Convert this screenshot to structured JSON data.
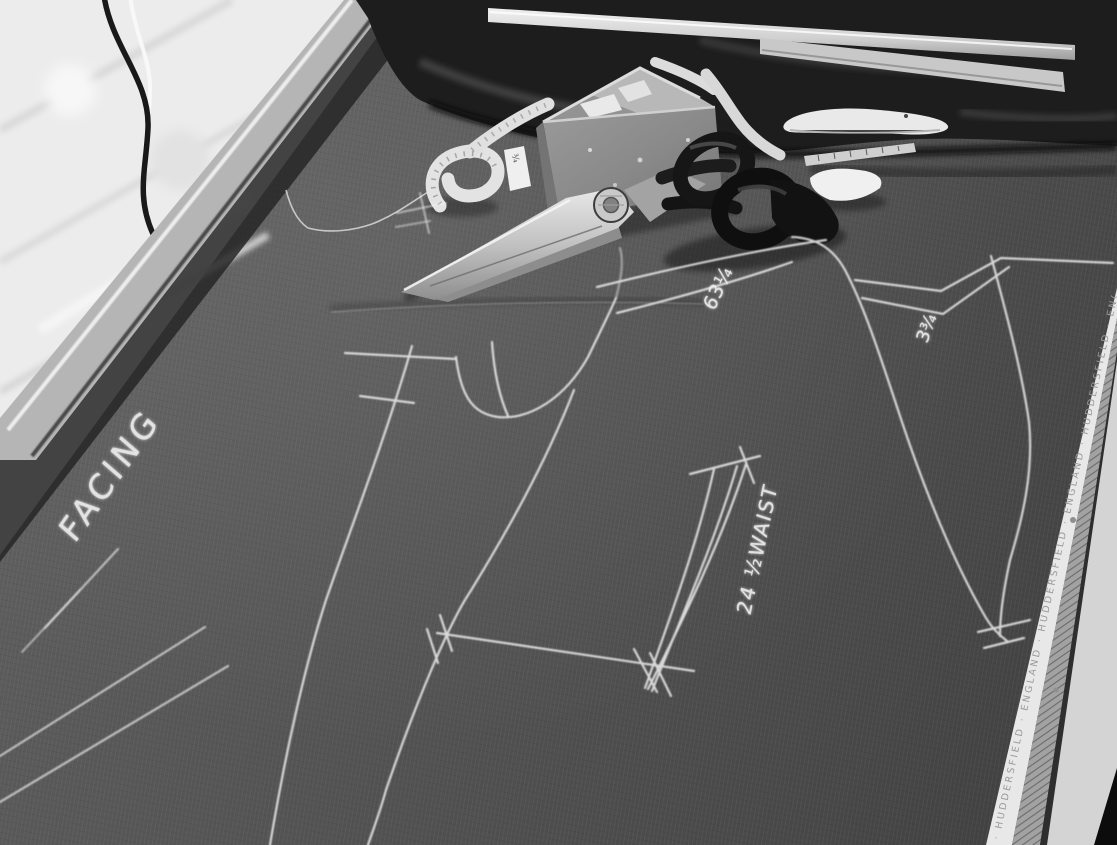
{
  "scene": {
    "alt": "Black-and-white photograph of a tailor's cutting table: dark suiting cloth chalked with pattern markings, tailor's shears, a chalk box with tape measure, long rulers on bundled cloth, a whitewashed brick wall at top left and the cloth selvage edge at right"
  },
  "chalk": {
    "facing": "FACING",
    "measure_63": "63¼",
    "waist": "24 ½WAIST",
    "measure_3": "3¾"
  },
  "selvage": {
    "text": "· HUDDERSFIELD · ENGLAND · HUDDERSFIELD · ENGLAND · HUDDERSFIELD · ENGLAND ·"
  },
  "tape": {
    "tag": "¾"
  },
  "palette": {
    "fabric": "#565656",
    "dark_cloth": "#1d1d1d",
    "wall_white": "#ededed",
    "rail_metal": "#b5b5b5",
    "chalk_line": "#f3f3f3",
    "selvage_white": "#e8e8e8",
    "table_edge_pale": "#d4d4d4",
    "corner_black": "#0c0c0c"
  }
}
